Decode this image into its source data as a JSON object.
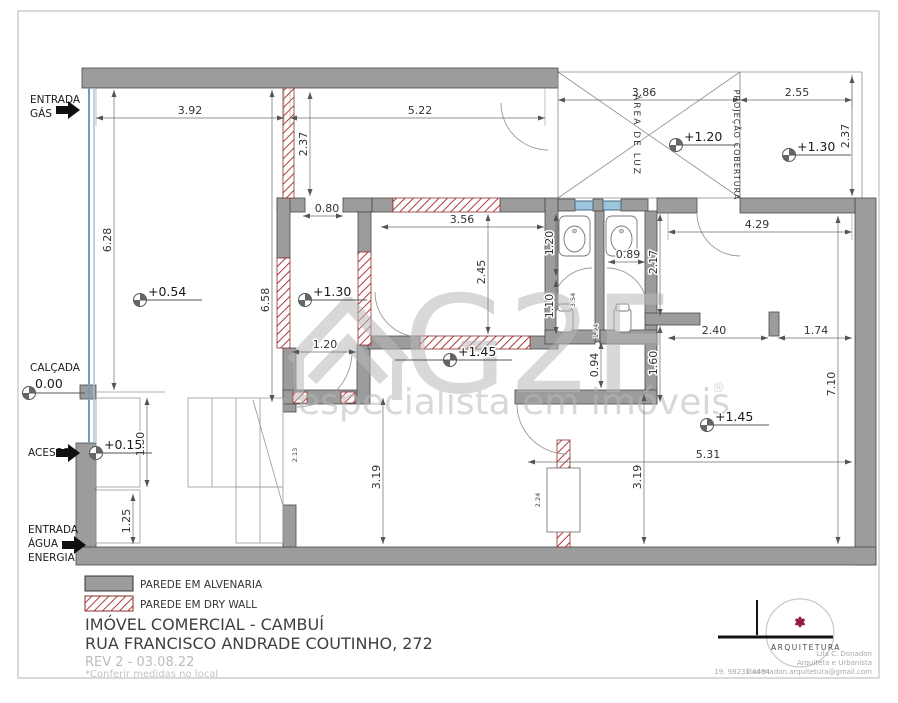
{
  "plan": {
    "side": {
      "gas1": "ENTRADA",
      "gas2": "GÁS",
      "calcada": "CALÇADA",
      "acesso": "ACESSO",
      "agua1": "ENTRADA",
      "agua2": "ÁGUA",
      "agua3": "ENERGIA"
    },
    "areas": {
      "luz": "ÁREA DE LUZ",
      "projecao": "PROJEÇÃO COBERTURA"
    },
    "levels": {
      "loja": "+0.54",
      "corredor": "+1.30",
      "sala": "+1.45",
      "luz": "+1.20",
      "cobertura": "+1.30",
      "fundos": "+1.45",
      "calcada": "0.00",
      "acesso": "+0.15"
    },
    "dims": {
      "w392": "3.92",
      "w522": "5.22",
      "w386": "3.86",
      "w255": "2.55",
      "h237l": "2.37",
      "h237r": "2.37",
      "h628": "6.28",
      "w080": "0.80",
      "w356": "3.56",
      "h245": "2.45",
      "h658": "6.58",
      "w120corr": "1.20",
      "h120": "1.20",
      "w089": "0.89",
      "h217": "2.17",
      "w429": "4.29",
      "h110": "1.10",
      "h354": "3.54",
      "h194": "1.94",
      "h094": "0.94",
      "w240": "2.40",
      "w174": "1.74",
      "h160": "1.60",
      "h710": "7.10",
      "h180": "1.80",
      "h125": "1.25",
      "h213": "2.13",
      "h319a": "3.19",
      "h319b": "3.19",
      "h224": "2.24",
      "w531": "5.31"
    }
  },
  "watermark": {
    "brand": "G2F",
    "tagline": "especialista em imóveis",
    "reg": "®"
  },
  "legend": {
    "alvenaria": "PAREDE EM ALVENARIA",
    "drywall": "PAREDE EM DRY WALL"
  },
  "title_block": {
    "line1": "IMÓVEL COMERCIAL - CAMBUÍ",
    "line2": "RUA FRANCISCO ANDRADE COUTINHO, 272",
    "rev": "REV 2 - 03.08.22",
    "note": "*Conferir medidas no local"
  },
  "logo": {
    "brand": "ARQUITETURA",
    "name": "Lila C. Donadon",
    "role": "Arquiteta e Urbanista",
    "phone": "19. 98231.4494",
    "email": "liladonadon.arquitetura@gmail.com"
  },
  "colors": {
    "wall": "#9c9c9c",
    "drywall": "#b03a3a",
    "window": "#9dc6dd",
    "glass": "#6f9fc0",
    "accent": "#8e2044"
  }
}
